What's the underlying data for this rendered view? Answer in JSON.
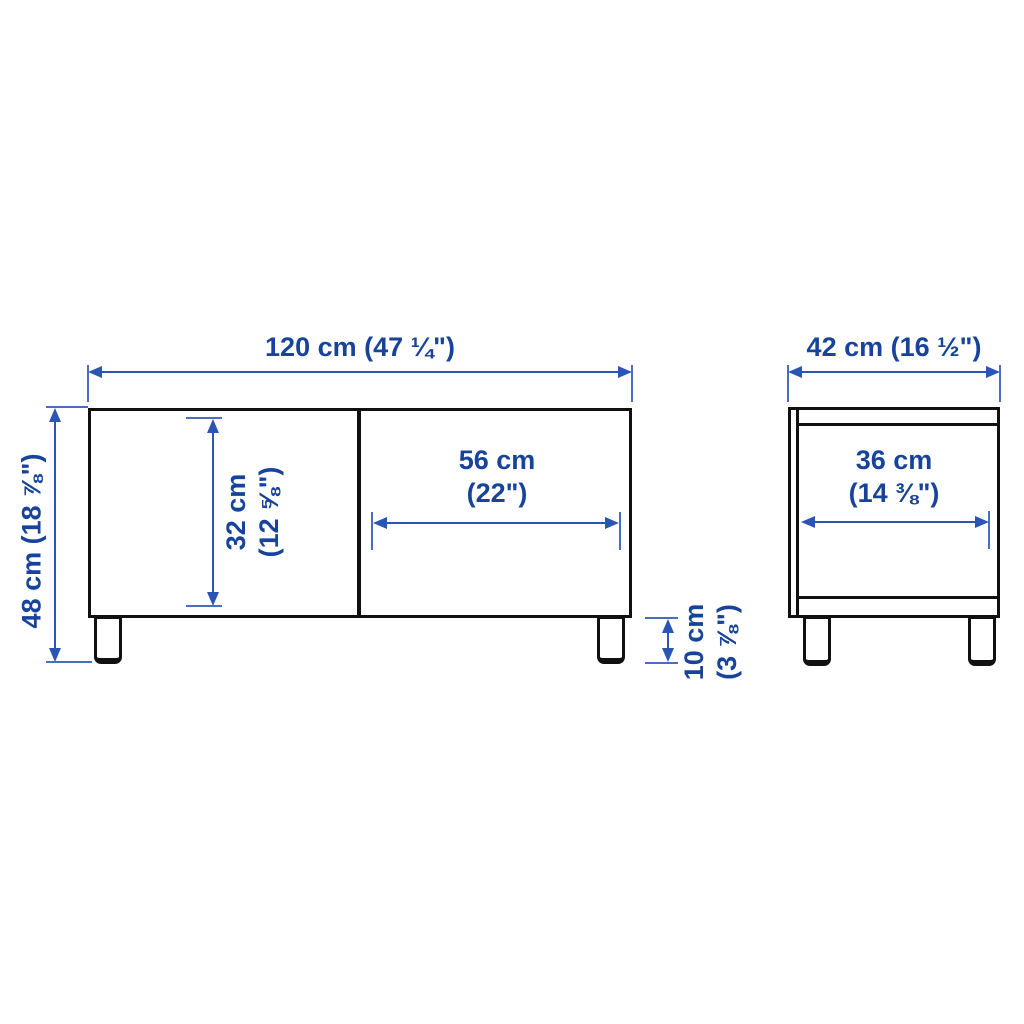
{
  "colors": {
    "outline": "#111111",
    "dimension_blue": "#2a55b4",
    "label_blue": "#17439b",
    "background": "#ffffff"
  },
  "views": {
    "front": {
      "labels": {
        "width": "120 cm (47 ¼\")",
        "height": "48 cm (18 ⅞\")",
        "inner_height": [
          "32 cm",
          "(12 ⅝\")"
        ],
        "door_width": [
          "56 cm",
          "(22\")"
        ],
        "leg_height": [
          "10 cm",
          "(3 ⅞\")"
        ]
      }
    },
    "side": {
      "labels": {
        "depth": "42 cm (16 ½\")",
        "inner_depth": [
          "36 cm",
          "(14 ⅜\")"
        ]
      }
    }
  }
}
